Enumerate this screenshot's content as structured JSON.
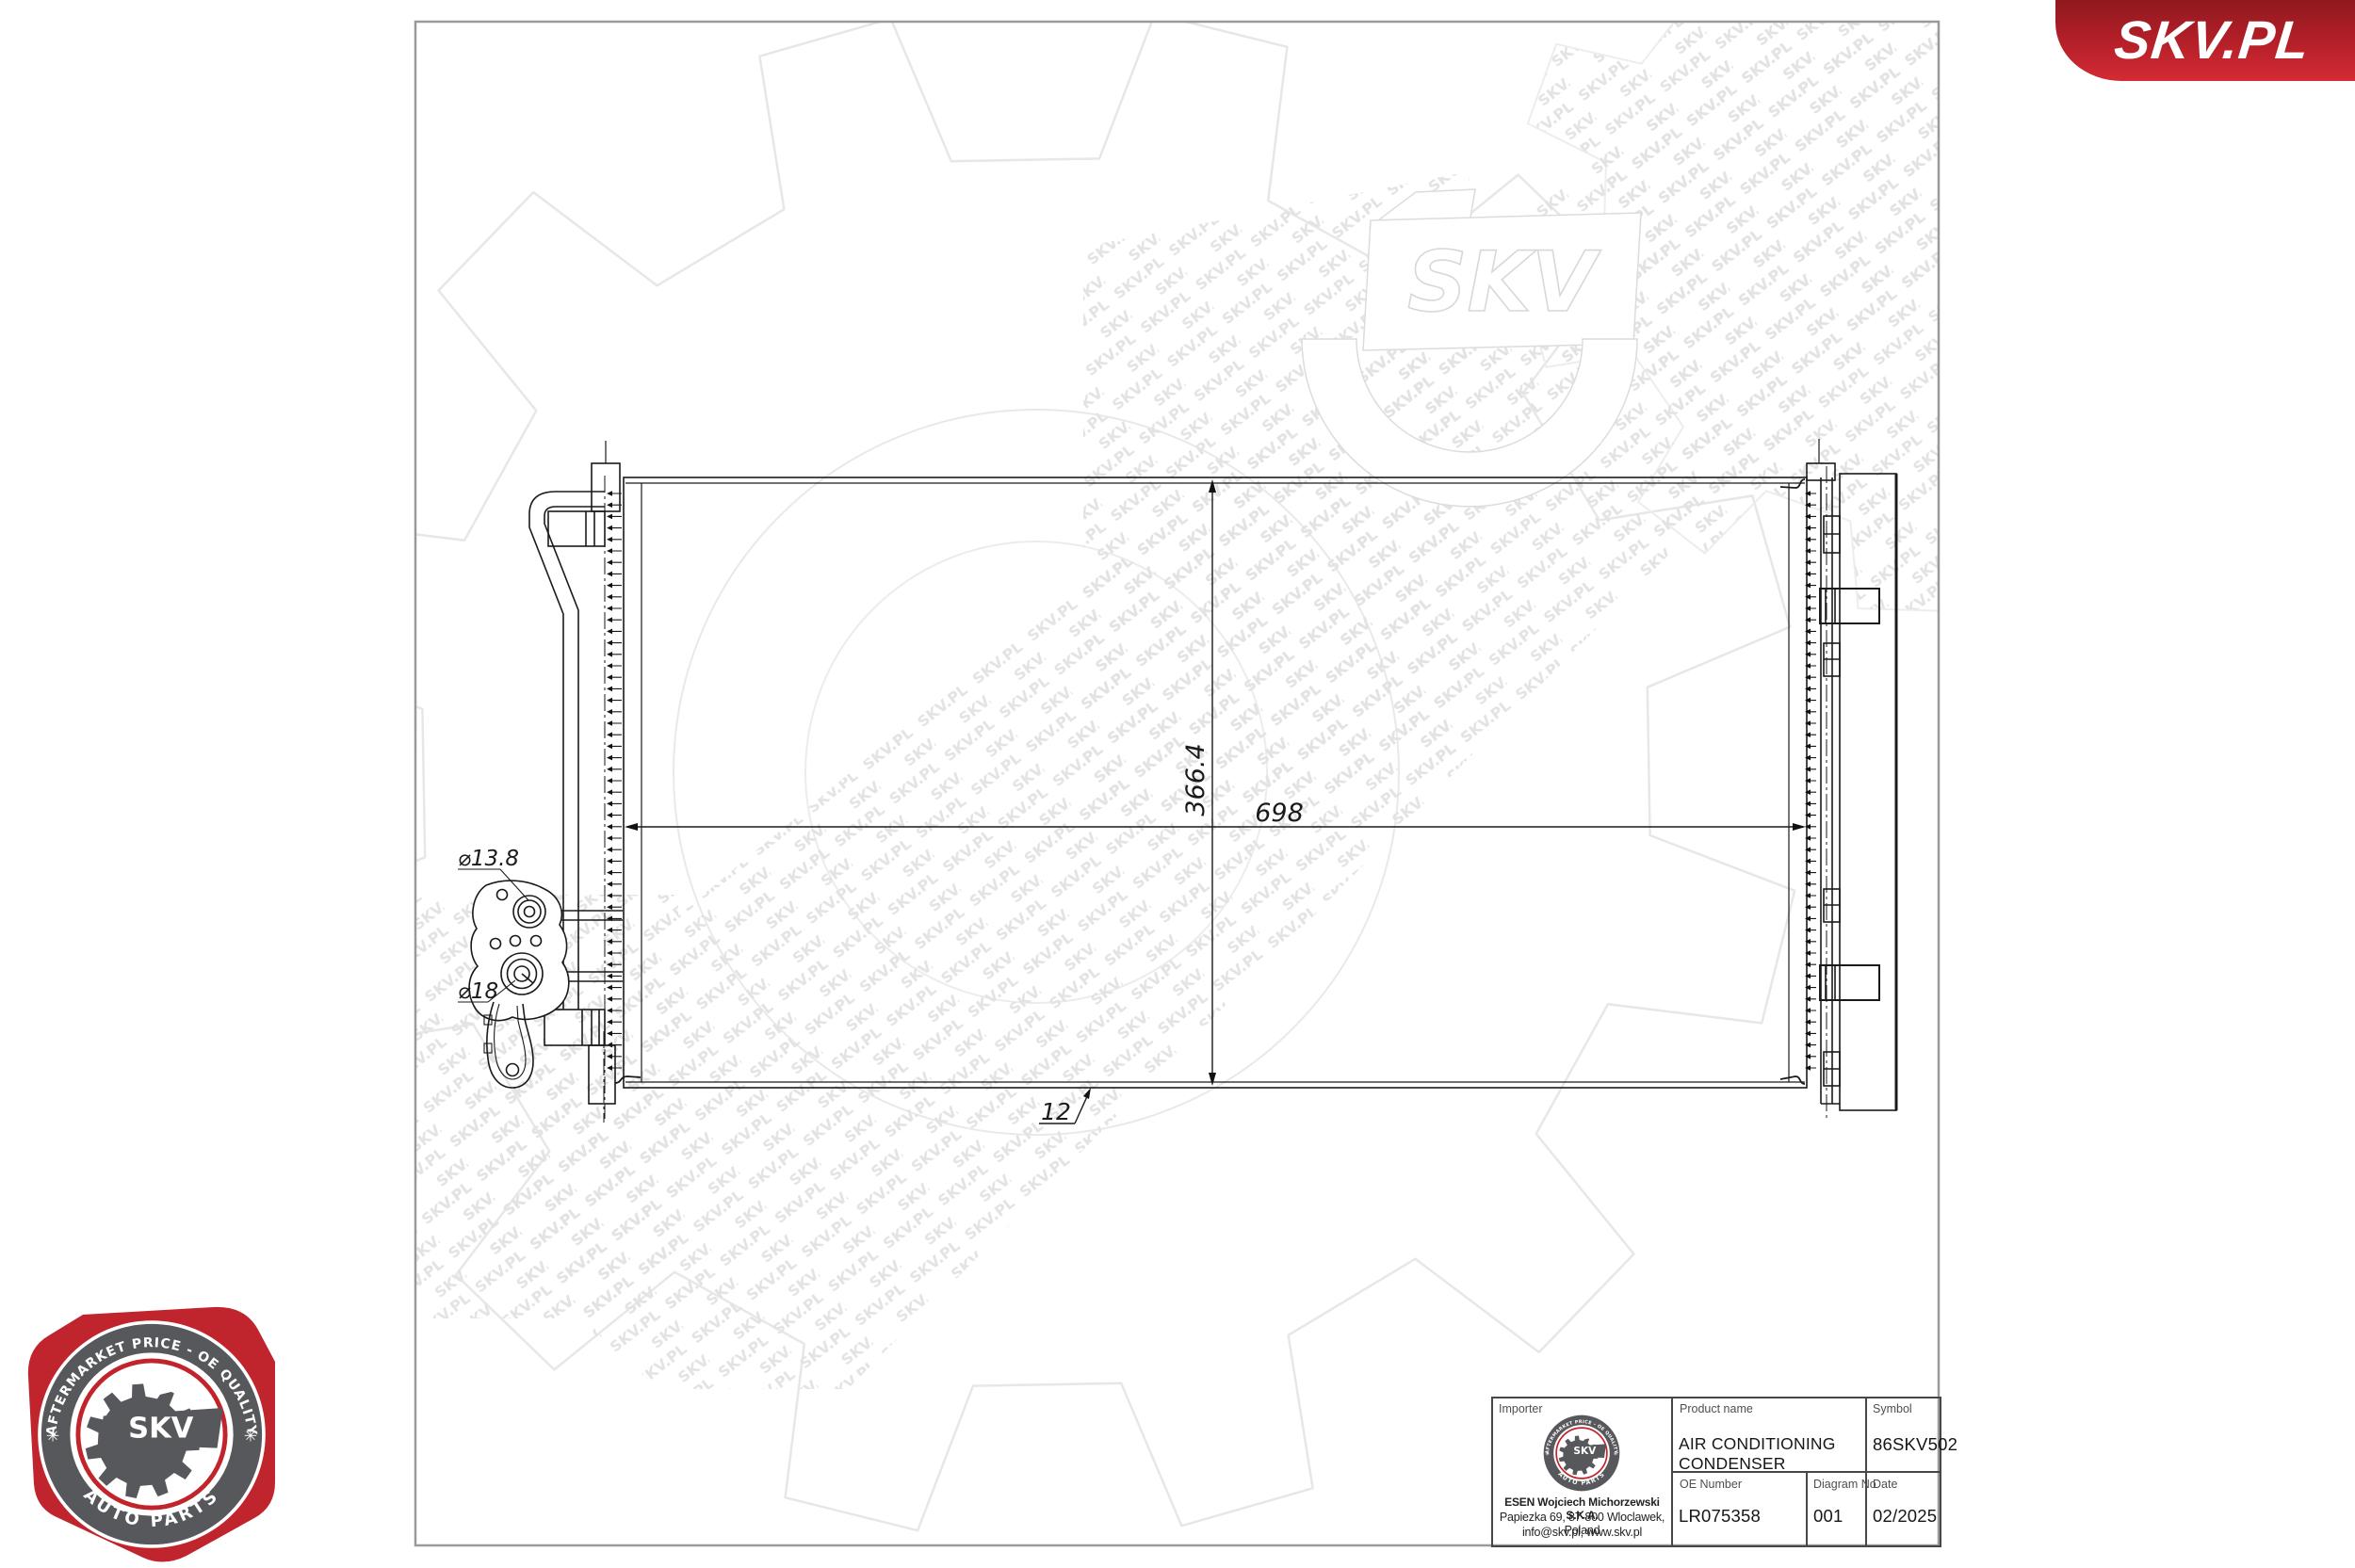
{
  "banner": {
    "text": "SKV.PL"
  },
  "colors": {
    "accent_red": "#c0232c",
    "badge_gray": "#57585b",
    "red_ring": "#c2242b"
  },
  "badge": {
    "top_text": "AFTERMARKET PRICE - OE QUALITY",
    "bottom_text": "AUTO PARTS",
    "center_text": "SKV",
    "star": "✳"
  },
  "watermark": {
    "tile_text": "SKV.PL",
    "logo_text": "SKV"
  },
  "drawing": {
    "dims": {
      "width": "698",
      "height": "366.4",
      "tube": "12",
      "port_small": "⌀13.8",
      "port_large": "⌀18"
    }
  },
  "title_block": {
    "importer_label": "Importer",
    "importer_name": "ESEN Wojciech Michorzewski S.K.A.",
    "importer_address": "Papiezka 69, 87-800 Wloclawek, Poland",
    "importer_contact": "info@skv.pl, www.skv.pl",
    "product_label": "Product name",
    "product_name": "AIR CONDITIONING CONDENSER",
    "symbol_label": "Symbol",
    "symbol": "86SKV502",
    "oe_label": "OE Number",
    "oe_number": "LR075358",
    "diagram_label": "Diagram No",
    "diagram_no": "001",
    "date_label": "Date",
    "date": "02/2025"
  }
}
